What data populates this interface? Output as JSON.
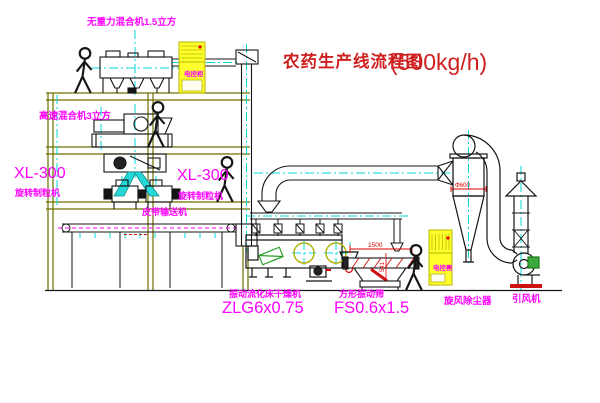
{
  "title": {
    "name_cn": "农药生产线流程图",
    "capacity": "(500kg/h)"
  },
  "equipment_labels": {
    "gravity_free_mixer": "无重力混合机1.5立方",
    "high_speed_mixer": "高速混合机3立方",
    "granulator_left_model": "XL-300",
    "granulator_left_name": "旋转制粒机",
    "granulator_right_model": "XL-300",
    "granulator_right_name": "旋转制粒机",
    "belt_conveyor": "皮带输送机",
    "fluid_bed_dryer_name": "振动流化床干燥机",
    "fluid_bed_dryer_model": "ZLG6x0.75",
    "vibrating_screen_name": "方形振动筛",
    "vibrating_screen_model": "FS0.6x1.5",
    "cyclone_dust_collector": "旋风除尘器",
    "induced_draft_fan": "引风机",
    "control_cabinet_top": "电控柜",
    "control_cabinet_right": "电控柜"
  },
  "dimension_annotations": {
    "screen_length": "1500",
    "screen_height": "541",
    "cyclone_diameter": "Φ600"
  },
  "colors": {
    "label_magenta": "#ff00ff",
    "title_red": "#cf2020",
    "structure_olive": "#6f6f00",
    "centerline_cyan": "#00d8d8",
    "cabinet_yellow": "#ffff2e",
    "machine_green": "#2aa02a",
    "dimension_red": "#e00000",
    "linework_black": "#151515"
  }
}
